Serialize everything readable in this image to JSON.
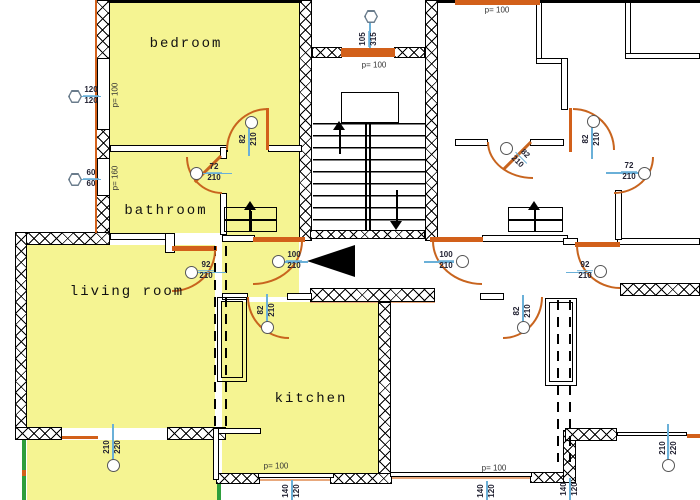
{
  "plan": {
    "unit_label": "S5",
    "unit_label_pos": {
      "x": 127,
      "y": 357
    },
    "rooms": [
      {
        "id": "bedroom",
        "label": "bedroom",
        "x": 186,
        "y": 44
      },
      {
        "id": "bathroom",
        "label": "bathroom",
        "x": 166,
        "y": 211
      },
      {
        "id": "living-room",
        "label": "living room",
        "x": 127,
        "y": 292
      },
      {
        "id": "kitchen",
        "label": "kitchen",
        "x": 311,
        "y": 399
      }
    ],
    "p_labels": [
      {
        "t": "p= 100",
        "x": 115,
        "y": 95,
        "rot": -90
      },
      {
        "t": "p= 160",
        "x": 115,
        "y": 178,
        "rot": -90
      },
      {
        "t": "p= 100",
        "x": 374,
        "y": 65,
        "rot": 0
      },
      {
        "t": "p= 100",
        "x": 497,
        "y": 10,
        "rot": 0
      },
      {
        "t": "p= 100",
        "x": 276,
        "y": 466,
        "rot": 0
      },
      {
        "t": "p= 100",
        "x": 494,
        "y": 468,
        "rot": 0
      }
    ],
    "dims": [
      {
        "a": "82",
        "b": "210",
        "cx": 249,
        "cy": 139,
        "rot": -90,
        "circle": [
          245,
          116
        ],
        "line": [
          248,
          126,
          1.5,
          30
        ]
      },
      {
        "a": "72",
        "b": "210",
        "cx": 214,
        "cy": 173,
        "rot": 0,
        "circle": [
          190,
          167
        ],
        "line": [
          202,
          172.5,
          30,
          1.5
        ]
      },
      {
        "a": "92",
        "b": "210",
        "cx": 206,
        "cy": 271,
        "rot": 0,
        "circle": [
          185,
          266
        ],
        "line": [
          197,
          271.5,
          29,
          1.5
        ]
      },
      {
        "a": "100",
        "b": "210",
        "cx": 294,
        "cy": 261,
        "rot": 0,
        "circle": [
          272,
          255
        ],
        "line": [
          283,
          261,
          25,
          1.5
        ]
      },
      {
        "a": "82",
        "b": "210",
        "cx": 267,
        "cy": 310,
        "rot": -90,
        "circle": [
          261,
          321
        ],
        "line": [
          266,
          294,
          1.5,
          30
        ]
      },
      {
        "a": "210",
        "b": "220",
        "cx": 113,
        "cy": 447,
        "rot": -90,
        "circle": [
          107,
          459
        ],
        "line": [
          112,
          424,
          1.5,
          38
        ]
      },
      {
        "a": "140",
        "b": "120",
        "cx": 292,
        "cy": 491,
        "rot": -90,
        "line": [
          291,
          480,
          1.5,
          20
        ]
      },
      {
        "a": "120",
        "b": "120",
        "cx": 91,
        "cy": 96,
        "rot": 0,
        "hex": [
          68,
          90
        ],
        "line": [
          81,
          95.5,
          20,
          1.5
        ]
      },
      {
        "a": "60",
        "b": "60",
        "cx": 91,
        "cy": 179,
        "rot": 0,
        "hex": [
          68,
          173
        ],
        "line": [
          81,
          178.5,
          20,
          1.5
        ]
      },
      {
        "a": "105",
        "b": "315",
        "cx": 369,
        "cy": 39,
        "rot": -90,
        "hex": [
          364,
          10
        ],
        "line": [
          369,
          22,
          1.5,
          26
        ]
      },
      {
        "a": "82",
        "b": "210",
        "cx": 592,
        "cy": 139,
        "rot": -90,
        "circle": [
          587,
          115
        ],
        "line": [
          591,
          127,
          1.5,
          32
        ]
      },
      {
        "a": "72",
        "b": "210",
        "cx": 629,
        "cy": 172,
        "rot": 0,
        "circle": [
          638,
          167
        ],
        "line": [
          606,
          172,
          33,
          1.5
        ]
      },
      {
        "a": "92",
        "b": "210",
        "cx": 585,
        "cy": 271,
        "rot": 0,
        "circle": [
          594,
          265
        ],
        "line": [
          566,
          271.5,
          26,
          1.5
        ]
      },
      {
        "a": "100",
        "b": "210",
        "cx": 446,
        "cy": 261,
        "rot": 0,
        "circle": [
          456,
          255
        ],
        "line": [
          424,
          261,
          30,
          1.5
        ]
      },
      {
        "a": "82",
        "b": "210",
        "cx": 523,
        "cy": 311,
        "rot": -90,
        "circle": [
          517,
          321
        ],
        "line": [
          522,
          295,
          1.5,
          30
        ]
      },
      {
        "a": "140",
        "b": "120",
        "cx": 570,
        "cy": 489,
        "rot": -90,
        "line": [
          569,
          478,
          1.5,
          22
        ]
      },
      {
        "a": "140",
        "b": "120",
        "cx": 487,
        "cy": 491,
        "rot": -90,
        "line": [
          486,
          481,
          1.5,
          19
        ]
      },
      {
        "a": "210",
        "b": "220",
        "cx": 669,
        "cy": 448,
        "rot": -90,
        "circle": [
          662,
          459
        ],
        "line": [
          667,
          424,
          1.5,
          38
        ]
      },
      {
        "a": "82",
        "b": "210",
        "cx": 521,
        "cy": 158,
        "rot": 45,
        "circle": [
          500,
          142
        ]
      }
    ],
    "yellows": [
      [
        110,
        3,
        192,
        145
      ],
      [
        110,
        148,
        112,
        85
      ],
      [
        222,
        147,
        77,
        150
      ],
      [
        27,
        245,
        188,
        183
      ],
      [
        222,
        302,
        156,
        171
      ],
      [
        27,
        440,
        190,
        60
      ]
    ],
    "xwalls": [
      [
        15,
        232,
        95,
        13
      ],
      [
        15,
        232,
        12,
        208
      ],
      [
        15,
        427,
        47,
        13
      ],
      [
        167,
        427,
        59,
        13
      ],
      [
        96,
        0,
        14,
        60
      ],
      [
        96,
        125,
        14,
        36
      ],
      [
        96,
        193,
        14,
        40
      ],
      [
        299,
        0,
        13,
        241
      ],
      [
        425,
        0,
        13,
        241
      ],
      [
        312,
        47,
        30,
        11
      ],
      [
        394,
        47,
        31,
        11
      ],
      [
        310,
        288,
        125,
        14
      ],
      [
        378,
        302,
        13,
        172
      ],
      [
        216,
        473,
        44,
        11
      ],
      [
        330,
        473,
        62,
        11
      ],
      [
        530,
        472,
        46,
        11
      ],
      [
        563,
        430,
        13,
        53
      ],
      [
        565,
        428,
        52,
        13
      ],
      [
        620,
        283,
        80,
        13
      ],
      [
        310,
        230,
        115,
        9
      ]
    ],
    "twalls": [
      [
        97,
        58,
        13,
        72
      ],
      [
        97,
        158,
        13,
        38
      ],
      [
        110,
        145,
        118,
        7
      ],
      [
        268,
        145,
        34,
        7
      ],
      [
        110,
        233,
        58,
        7
      ],
      [
        165,
        233,
        10,
        20
      ],
      [
        220,
        147,
        7,
        12
      ],
      [
        220,
        193,
        7,
        42
      ],
      [
        222,
        235,
        33,
        7
      ],
      [
        482,
        235,
        86,
        7
      ],
      [
        563,
        238,
        15,
        7
      ],
      [
        617,
        238,
        83,
        7
      ],
      [
        615,
        190,
        7,
        50
      ],
      [
        222,
        293,
        26,
        7
      ],
      [
        287,
        293,
        25,
        7
      ],
      [
        480,
        293,
        24,
        7
      ],
      [
        213,
        428,
        48,
        6
      ],
      [
        213,
        428,
        6,
        52
      ],
      [
        258,
        473,
        76,
        5
      ],
      [
        390,
        472,
        142,
        5
      ],
      [
        617,
        432,
        70,
        4
      ],
      [
        536,
        0,
        6,
        63
      ],
      [
        536,
        58,
        30,
        6
      ],
      [
        561,
        58,
        7,
        52
      ],
      [
        625,
        0,
        6,
        58
      ],
      [
        625,
        53,
        75,
        6
      ],
      [
        530,
        139,
        34,
        7
      ],
      [
        455,
        139,
        33,
        7
      ]
    ],
    "solids": [
      [
        110,
        0,
        192,
        3
      ],
      [
        437,
        0,
        263,
        3
      ],
      [
        365,
        123,
        1.5,
        107
      ],
      [
        369,
        123,
        1.5,
        107
      ],
      [
        249,
        207,
        1.5,
        25
      ],
      [
        224,
        219,
        53,
        1.5
      ],
      [
        534,
        207,
        1.5,
        25
      ],
      [
        508,
        219,
        55,
        1.5
      ],
      [
        339,
        130,
        1.5,
        24
      ],
      [
        396,
        190,
        1.5,
        33
      ],
      [
        250,
        211,
        1.5,
        21
      ],
      [
        534,
        211,
        1.5,
        21
      ]
    ],
    "oranges": [
      [
        341,
        48,
        54,
        9
      ],
      [
        455,
        0,
        85,
        5
      ],
      [
        253,
        237,
        52,
        5
      ],
      [
        430,
        237,
        53,
        5
      ],
      [
        172,
        246,
        45,
        5
      ],
      [
        575,
        242,
        45,
        5
      ],
      [
        95,
        0,
        2,
        233
      ],
      [
        62,
        436,
        36,
        3
      ],
      [
        687,
        434,
        13,
        4
      ],
      [
        22,
        470,
        4,
        6
      ],
      [
        569,
        108,
        3,
        44
      ],
      [
        266,
        108,
        2.5,
        42
      ]
    ],
    "orangels": [
      [
        310,
        300,
        125,
        3
      ],
      [
        258,
        479,
        76,
        2
      ],
      [
        530,
        481,
        46,
        2
      ],
      [
        390,
        477,
        142,
        2
      ]
    ],
    "greens": [
      [
        22,
        440,
        4,
        60
      ],
      [
        217,
        480,
        4,
        20
      ]
    ],
    "boxes": [
      [
        341,
        92,
        58,
        31
      ],
      [
        217,
        297,
        30,
        85
      ],
      [
        221,
        301,
        22,
        77
      ],
      [
        545,
        298,
        32,
        88
      ],
      [
        549,
        302,
        24,
        80
      ],
      [
        224,
        207,
        53,
        25
      ],
      [
        508,
        207,
        55,
        25
      ]
    ],
    "dashes": [
      [
        214,
        246,
        184
      ],
      [
        225,
        246,
        184
      ],
      [
        557,
        300,
        162
      ],
      [
        569,
        300,
        162
      ]
    ],
    "arcs": [
      {
        "x": 226,
        "y": 108,
        "w": 42,
        "h": 42,
        "c": "tl"
      },
      {
        "x": 186,
        "y": 157,
        "w": 36,
        "h": 37,
        "c": "bl"
      },
      {
        "x": 172,
        "y": 250,
        "w": 44,
        "h": 42,
        "c": "br"
      },
      {
        "x": 253,
        "y": 241,
        "w": 50,
        "h": 44,
        "c": "br"
      },
      {
        "x": 247,
        "y": 297,
        "w": 42,
        "h": 42,
        "c": "bl"
      },
      {
        "x": 573,
        "y": 108,
        "w": 42,
        "h": 42,
        "c": "tr"
      },
      {
        "x": 614,
        "y": 157,
        "w": 40,
        "h": 37,
        "c": "br"
      },
      {
        "x": 576,
        "y": 245,
        "w": 44,
        "h": 44,
        "c": "bl"
      },
      {
        "x": 432,
        "y": 241,
        "w": 50,
        "h": 44,
        "c": "bl"
      },
      {
        "x": 503,
        "y": 297,
        "w": 40,
        "h": 42,
        "c": "br"
      },
      {
        "x": 487,
        "y": 142,
        "w": 46,
        "h": 37,
        "c": "bl"
      }
    ],
    "leaves": [
      {
        "x": 222,
        "y": 157,
        "len": 37,
        "rot": 135
      },
      {
        "x": 532,
        "y": 143,
        "len": 38,
        "rot": 135
      }
    ],
    "treads_box": [
      313,
      123,
      112,
      107
    ],
    "arrows": [
      {
        "x": 307,
        "y": 245,
        "dir": "left",
        "w": 48,
        "h": 16,
        "name": "entrance-arrow"
      },
      {
        "x": 333,
        "y": 121,
        "dir": "up",
        "w": 6,
        "h": 9,
        "name": "stairs-up-arrow"
      },
      {
        "x": 390,
        "y": 221,
        "dir": "down",
        "w": 6,
        "h": 9,
        "name": "stairs-down-arrow"
      },
      {
        "x": 244,
        "y": 201,
        "dir": "up",
        "w": 6,
        "h": 9,
        "name": "entry-steps-arrow-left"
      },
      {
        "x": 528,
        "y": 201,
        "dir": "up",
        "w": 6,
        "h": 9,
        "name": "entry-steps-arrow-right"
      }
    ],
    "colors": {
      "apartment_fill": "#f5f492",
      "door_arc": "#c8641e",
      "window_orange": "#d2601a",
      "dimension_line_blue": "#6ab0d8",
      "balcony_green": "#2e9e3c",
      "wall_black": "#000000"
    }
  }
}
